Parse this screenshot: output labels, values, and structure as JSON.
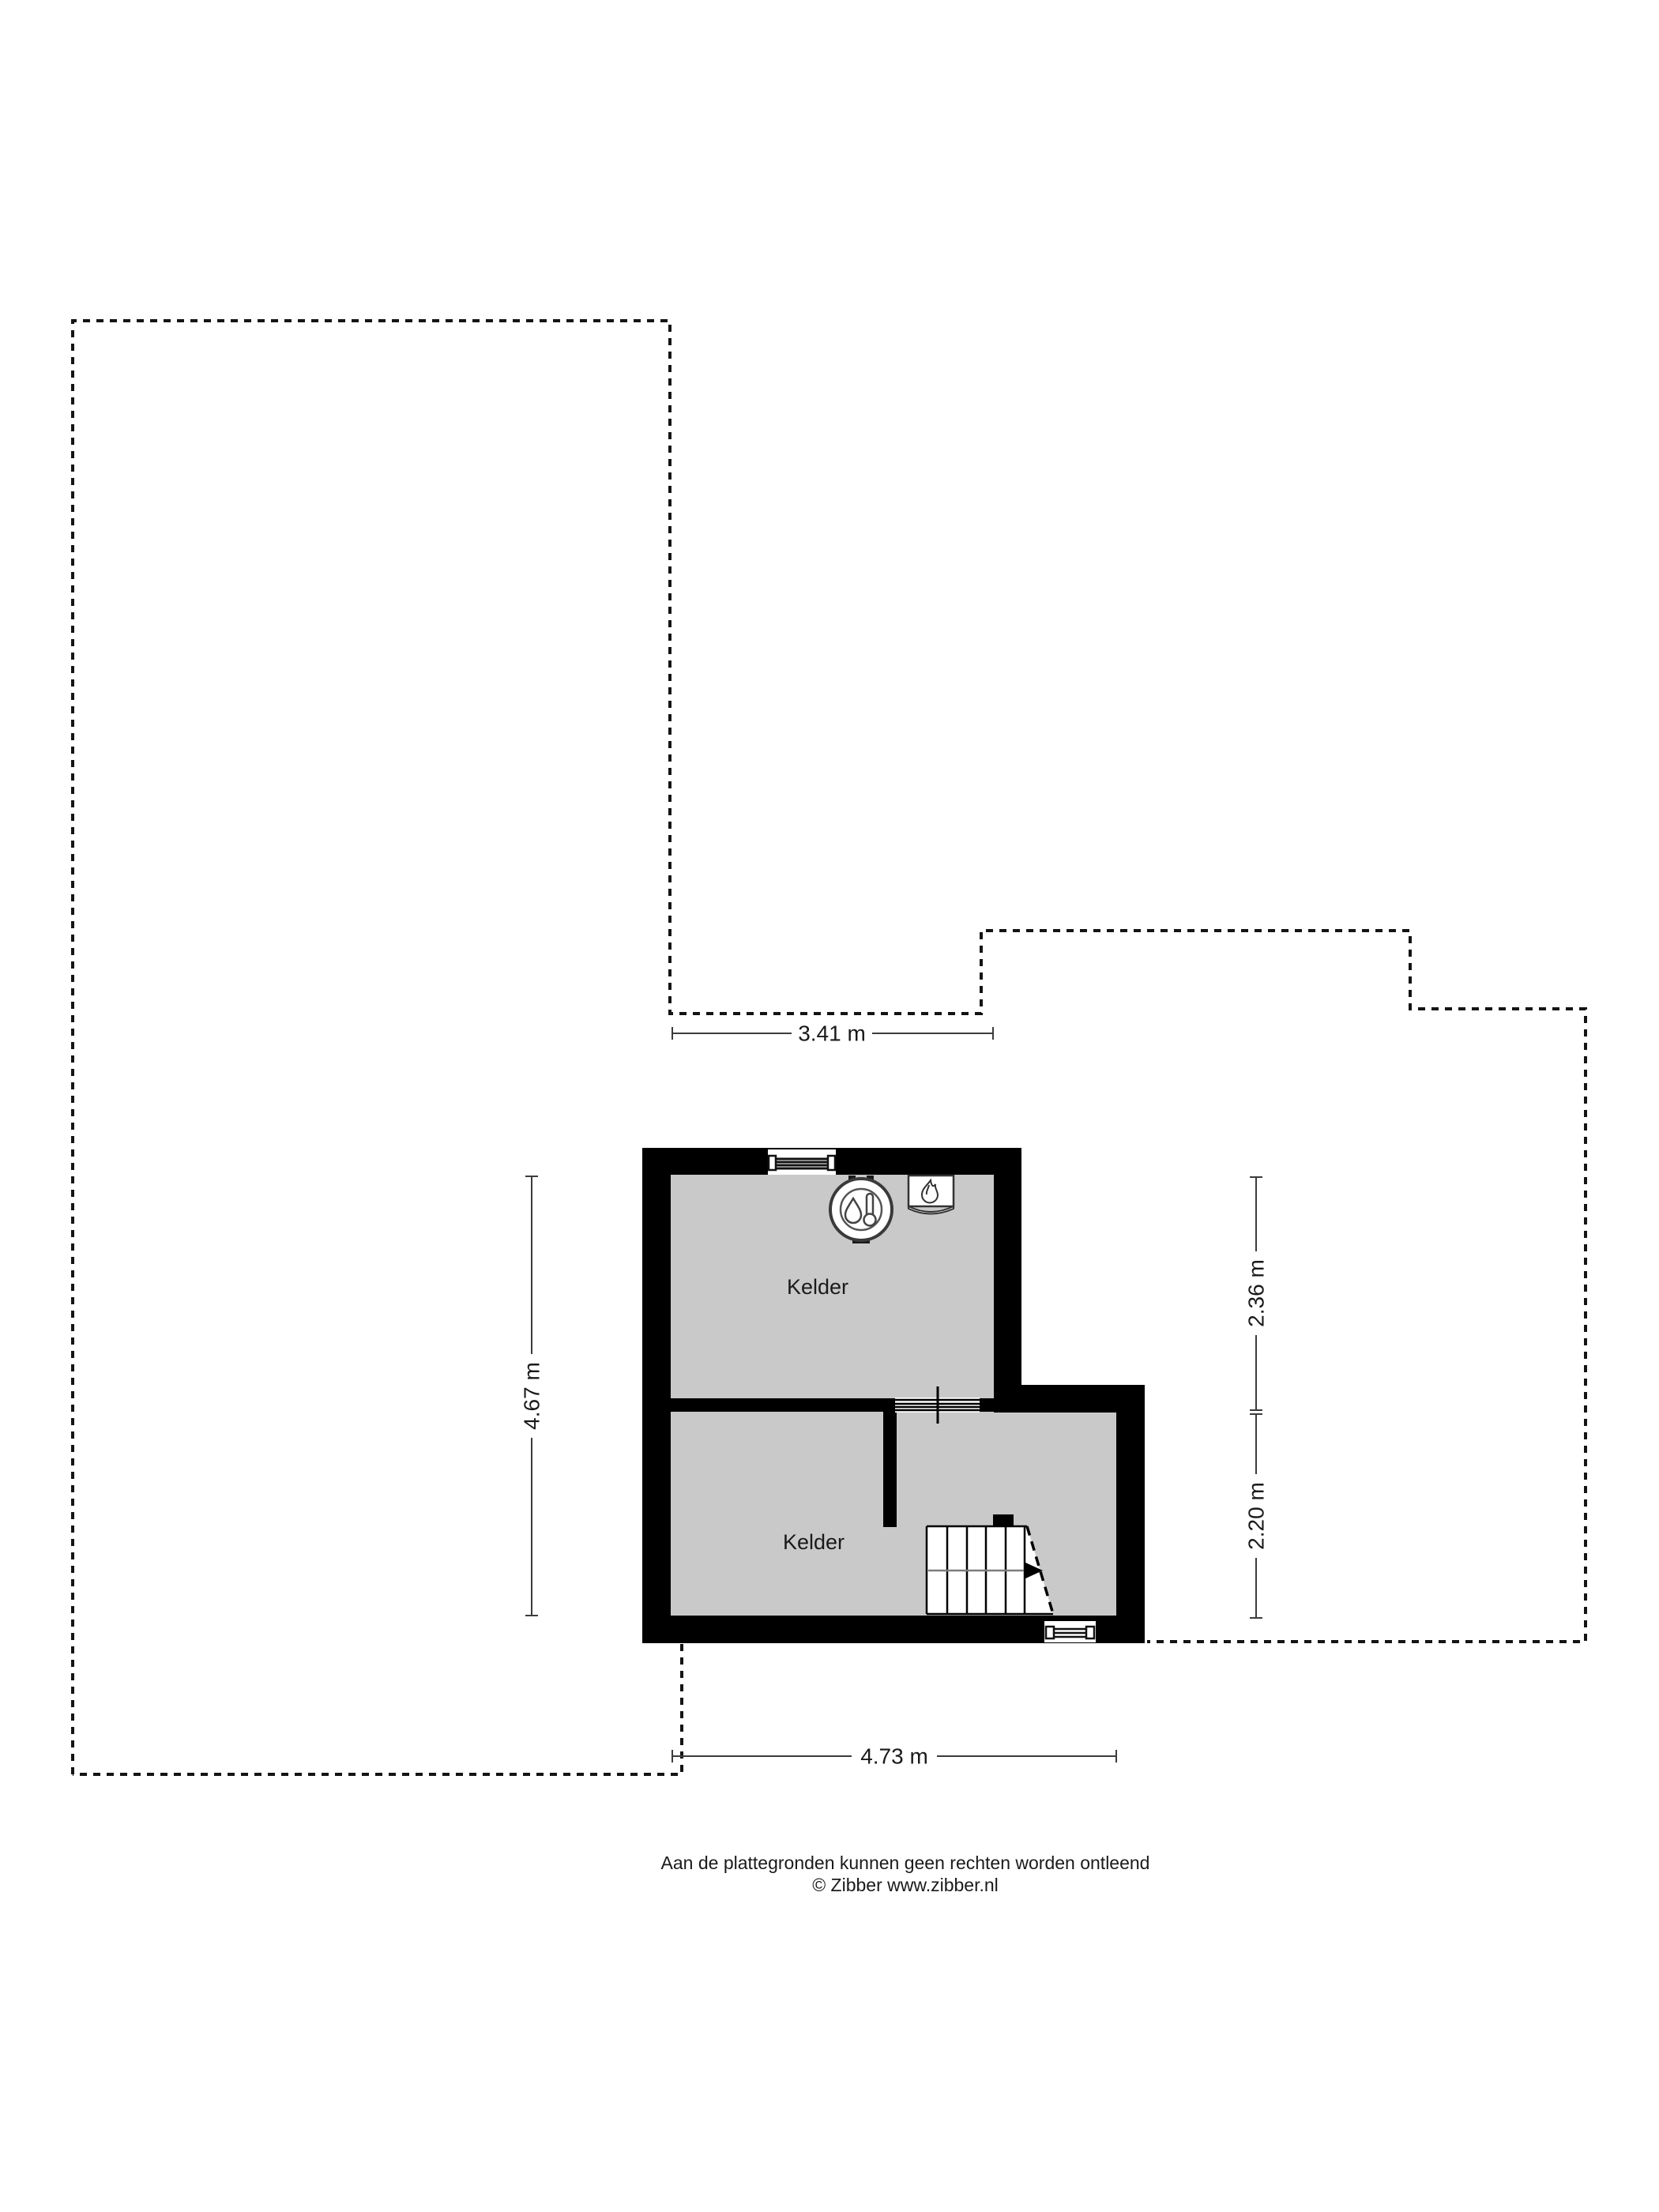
{
  "floor_plan": {
    "room_labels": [
      "Kelder",
      "Kelder"
    ],
    "dimensions": {
      "top": "3.41 m",
      "left": "4.67 m",
      "right_upper": "2.36 m",
      "right_lower": "2.20 m",
      "bottom": "4.73 m"
    },
    "icons": [
      {
        "name": "boiler-thermometer-icon"
      },
      {
        "name": "heater-flame-icon"
      },
      {
        "name": "stair-direction-arrow-icon"
      }
    ],
    "colors": {
      "wall": "#000000",
      "floor": "#c9c9c9",
      "outline": "#141414",
      "dimension_line": "#3c3c3c",
      "walk_line": "#7d7d7d",
      "stair_fill": "#ffffff"
    }
  },
  "footer": {
    "disclaimer": "Aan de plattegronden kunnen geen rechten worden ontleend",
    "copyright": "© Zibber www.zibber.nl"
  }
}
